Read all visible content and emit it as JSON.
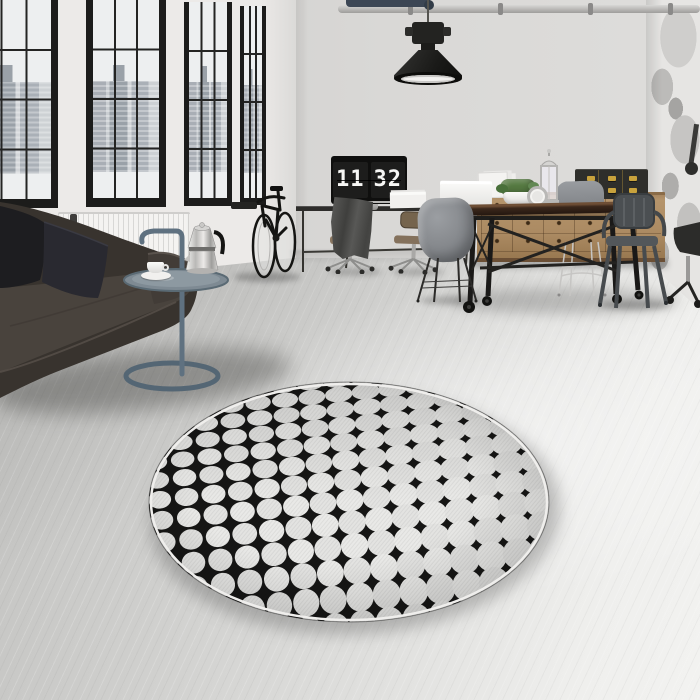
{
  "scene": {
    "title": "Industrial loft interior with round black-and-white patterned rug",
    "clock": {
      "hours": "11",
      "minutes": "32"
    }
  },
  "palette": {
    "wall": "#d6d5d3",
    "floor_light": "#efefed",
    "floor_dark": "#c2c2c0",
    "window_frame": "#1c1c1b",
    "sofa_leather": "#38332e",
    "side_table_teal": "#5f7180",
    "sideboard_wood": "#ab8a62",
    "table_wood": "#3a271b",
    "shell_chair_gray": "#84878b",
    "metal_chair": "#4b4f52",
    "brass": "#c8a23c",
    "plant_green": "#567a42",
    "rug_black": "#161615",
    "rug_white": "#e9e9e7"
  },
  "rug": {
    "base_color": "#161615",
    "dot_color": "#e9e9e7",
    "dot_color_alt": "#e3e3e1",
    "rim_color": "#efeeec",
    "col_width": 27,
    "row_min": 12.5,
    "row_max": 32,
    "scale_left": 0.8,
    "scale_right": 1.25,
    "rotation_deg": -6
  }
}
